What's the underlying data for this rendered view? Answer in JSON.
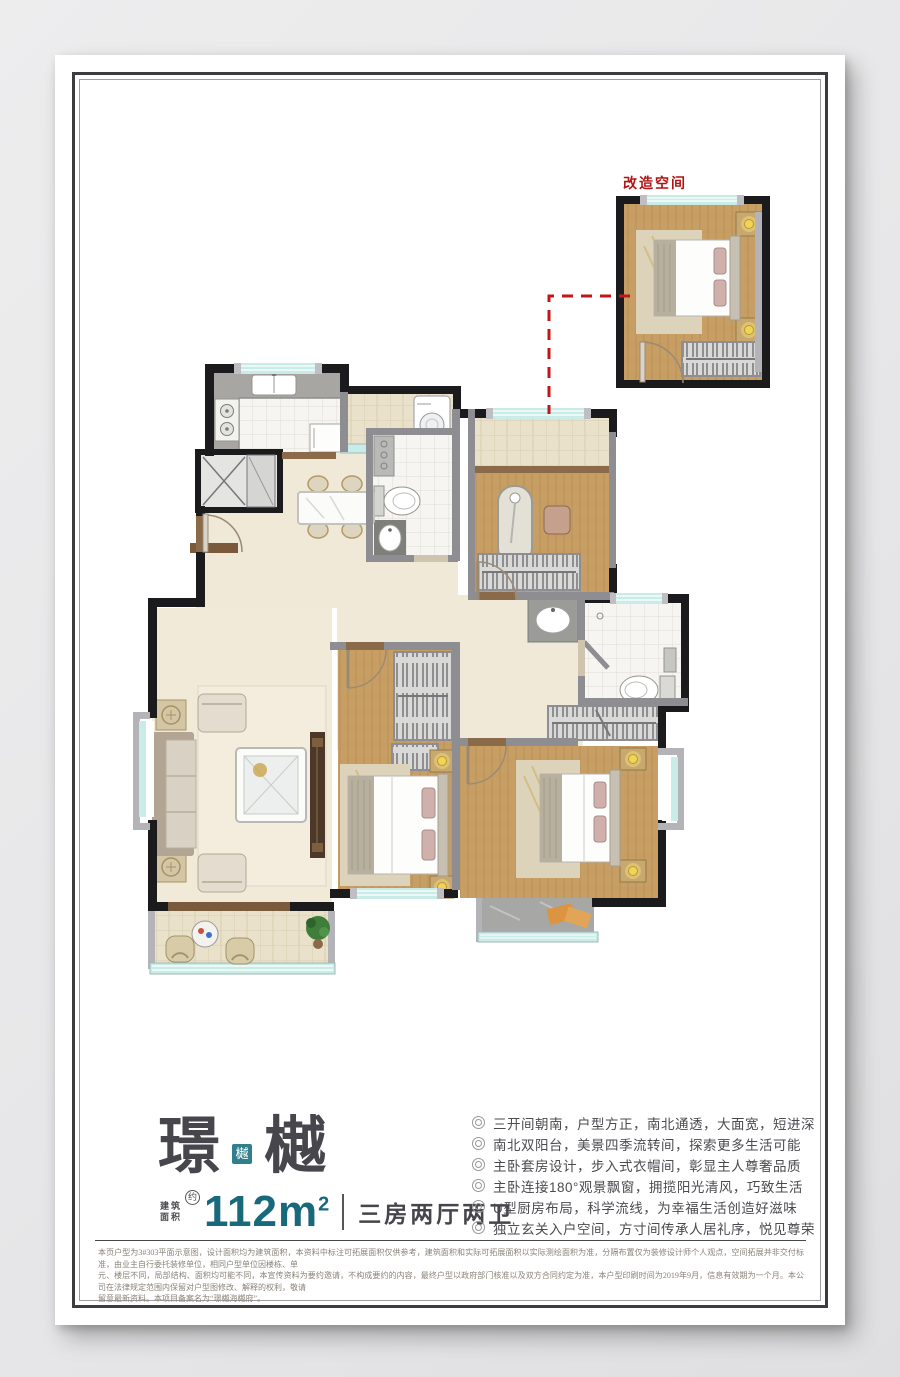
{
  "poster": {
    "inset_label": "改造空间",
    "title": {
      "char1": "璟",
      "seal": "樾",
      "char2": "樾"
    },
    "area": {
      "label_line1": "建筑",
      "label_line2": "面积",
      "approx": "约",
      "value": "112",
      "unit": "m",
      "sup": "2",
      "layout": "三房两厅两卫"
    },
    "features": [
      "三开间朝南，户型方正，南北通透，大面宽，短进深",
      "南北双阳台，美景四季流转间，探索更多生活可能",
      "主卧套房设计，步入式衣帽间，彰显主人尊奢品质",
      "主卧连接180°观景飘窗，拥揽阳光清风，巧致生活",
      "U型厨房布局，科学流线，为幸福生活创造好滋味",
      "独立玄关入户空间，方寸间传承人居礼序，悦见尊荣"
    ],
    "disclaimer": [
      "本页户型为3#303平面示意图，设计面积均为建筑面积，本资料中标注可拓展面积仅供参考，建筑面积和实际可拓展面积以实际测绘面积为准，分隔布置仅为装修设计师个人观点，空间拓展并非交付标准，由业主自行委托装修单位，相同户型单位因楼栋、单",
      "元、楼层不同，局部结构、面积均可能不同，本宣传资料为要约邀请，不构成要约的内容，最终户型以政府部门核准以及双方合同约定为准，本户型印刷时间为2019年9月，信息有效期为一个月。本公司在法律规定范围内保留对户型图修改、解释的权利，敬请",
      "留意最新资料。本项目备案名为“璟樾海樾府”。"
    ],
    "colors": {
      "accent_teal": "#19697c",
      "seal_teal": "#2f7f8c",
      "renovation_red": "#b31313",
      "wall_black": "#1b1b1e",
      "wood": "#c79e63",
      "window_glass": "#c9ece8"
    }
  }
}
